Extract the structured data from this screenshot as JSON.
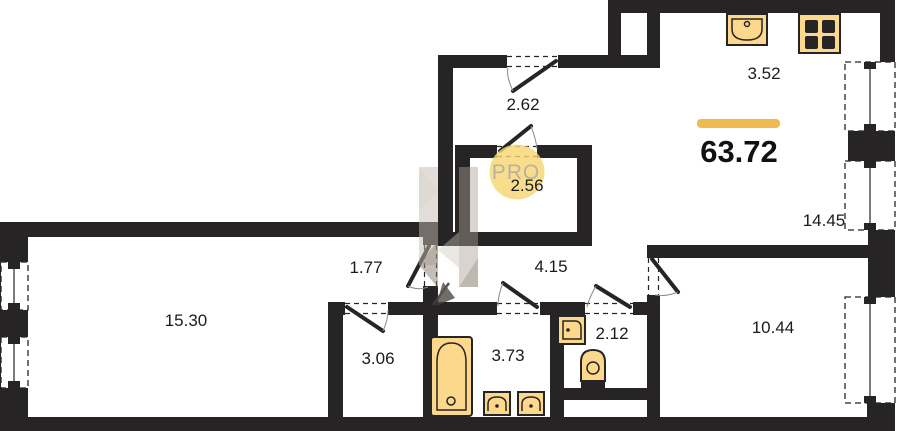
{
  "plan": {
    "type": "apartment-floor-plan",
    "total_area": {
      "value": "63.72",
      "unit_note": "value shown under yellow accent line"
    },
    "rooms": [
      {
        "name": "kitchen-zone",
        "area": "3.52"
      },
      {
        "name": "entry-hall",
        "area": "2.62"
      },
      {
        "name": "storage",
        "area": "2.56"
      },
      {
        "name": "living-room",
        "area": "14.45"
      },
      {
        "name": "inner-hall",
        "area": "1.77"
      },
      {
        "name": "corridor",
        "area": "4.15"
      },
      {
        "name": "bedroom-1",
        "area": "15.30"
      },
      {
        "name": "closet",
        "area": "3.06"
      },
      {
        "name": "bathroom",
        "area": "3.73"
      },
      {
        "name": "wc",
        "area": "2.12"
      },
      {
        "name": "bedroom-2",
        "area": "10.44"
      }
    ],
    "watermark": {
      "circle_label": "PRO"
    },
    "fixtures": [
      "kitchen-sink-icon",
      "stove-icon",
      "bathtub-icon",
      "sink-icon",
      "sink-icon",
      "corner-sink-icon",
      "toilet-icon"
    ],
    "colors": {
      "wall": "#262425",
      "background": "#ffffff",
      "accent_yellow": "#efba52",
      "fixture_fill": "#fcd88c",
      "fixture_stroke": "#262425",
      "watermark_circle": "#f6d673",
      "watermark_text": "#b3a896",
      "label_text": "#1b1b1b"
    }
  }
}
